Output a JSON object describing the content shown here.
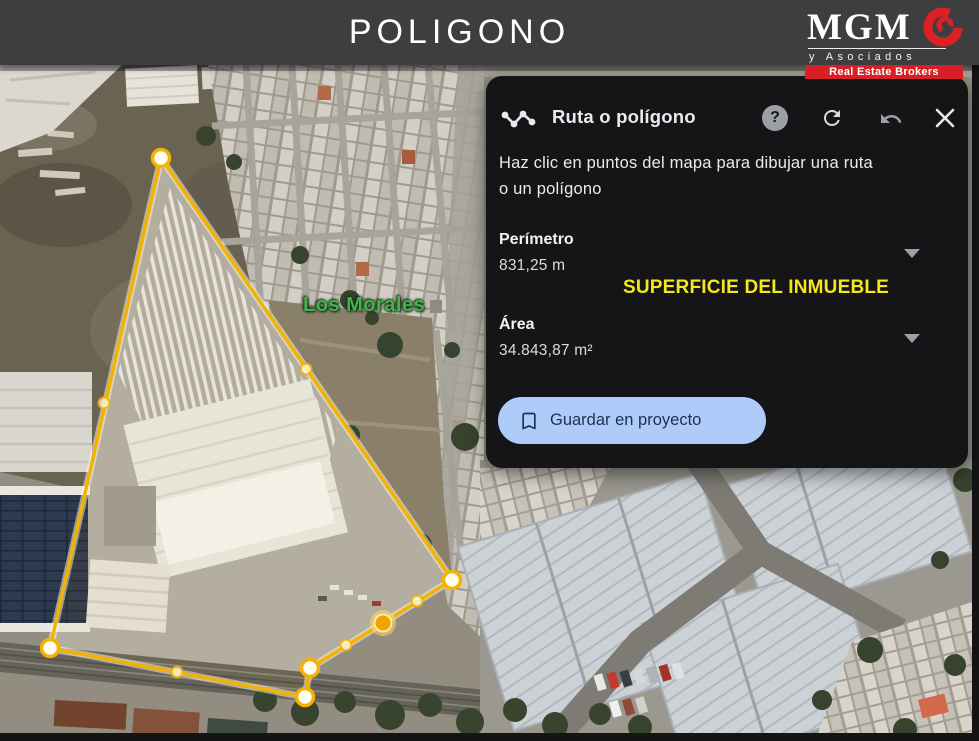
{
  "header": {
    "title": "POLIGONO"
  },
  "logo": {
    "name": "MGM",
    "subtitle": "y Asociados",
    "tagline": "Real Estate Brokers"
  },
  "panel": {
    "title": "Ruta o polígono",
    "instructions": "Haz clic en puntos del mapa para dibujar una ruta\no un polígono",
    "perimeter": {
      "label": "Perímetro",
      "value": "831,25 m"
    },
    "area": {
      "label": "Área",
      "value": "34.843,87 m²"
    },
    "annotation": "SUPERFICIE DEL INMUEBLE",
    "save_button": "Guardar en proyecto",
    "help_glyph": "?"
  },
  "map": {
    "place_label": "Los Morales",
    "polygon": {
      "stroke": "#f3b301",
      "halo": "rgba(255,255,255,0.5)",
      "vertex_fill": "#fffdf4",
      "active_core": "#f3a200",
      "active_ring": "rgba(255,221,92,0.55)",
      "midpoint_fill": "rgba(255,250,230,0.9)",
      "vertices": [
        [
          161,
          158
        ],
        [
          452,
          580
        ],
        [
          383,
          623
        ],
        [
          310,
          668
        ],
        [
          305,
          697
        ],
        [
          50,
          648
        ]
      ],
      "midpoints": [
        [
          306,
          369
        ],
        [
          417,
          601
        ],
        [
          346,
          645
        ],
        [
          177,
          672
        ],
        [
          104,
          403
        ]
      ],
      "active_vertex_index": 2
    }
  },
  "colors": {
    "accent_yellow": "#f3b301",
    "annotation_yellow": "#f4e81c",
    "button_bg": "#aecbfa",
    "button_text": "#1d3050",
    "brand_red": "#d81f26",
    "header_bg": "#3e3e40",
    "panel_bg": "#151517"
  }
}
